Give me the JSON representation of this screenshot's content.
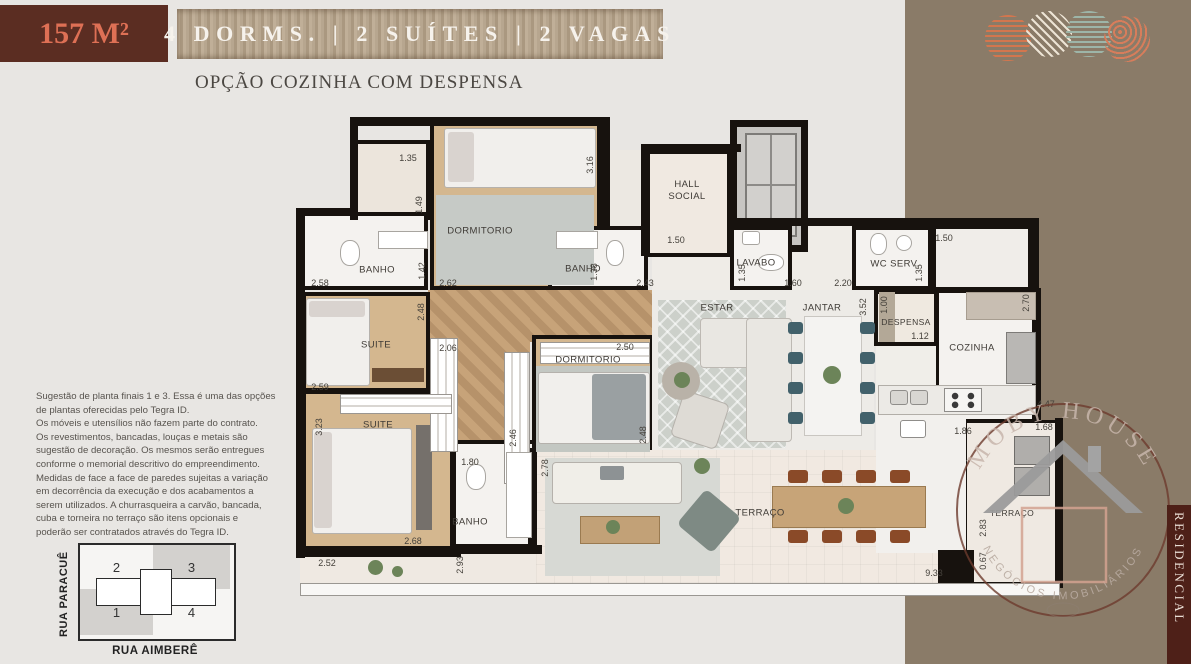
{
  "header": {
    "area": "157 M²",
    "banner": "4 DORMS. | 2 SUÍTES | 2 VAGAS",
    "subtitle": "OPÇÃO COZINHA COM DESPENSA"
  },
  "disclaimer": "Sugestão de planta finais 1 e 3.  Essa é uma das opções\nde plantas oferecidas pelo Tegra ID.\nOs móveis e utensílios não fazem parte do contrato.\nOs revestimentos, bancadas, louças e metais são\nsugestão de decoração. Os mesmos serão entregues\nconforme  o memorial descritivo do empreendimento.\nMedidas de face a face de paredes sujeitas a variação\nem decorrência da execução e dos acabamentos a\nserem utilizados. A churrasqueira a carvão, bancada,\ncuba e torneira no terraço são itens opcionais e\npoderão ser contratados através do Tegra ID.",
  "key_plan": {
    "street_left": "RUA PARACUÊ",
    "street_bottom": "RUA AIMBERÊ",
    "units": {
      "u1": "1",
      "u2": "2",
      "u3": "3",
      "u4": "4"
    }
  },
  "plan": {
    "rooms": [
      {
        "label": "DORMITORIO"
      },
      {
        "label": "BANHO"
      },
      {
        "label": "BANHO"
      },
      {
        "label": "HALL SOCIAL"
      },
      {
        "label": "LAVABO"
      },
      {
        "label": "WC SERV."
      },
      {
        "label": "SUITE"
      },
      {
        "label": "SUITE"
      },
      {
        "label": "DORMITORIO"
      },
      {
        "label": "ESTAR"
      },
      {
        "label": "JANTAR"
      },
      {
        "label": "DESPENSA"
      },
      {
        "label": "COZINHA"
      },
      {
        "label": "BANHO"
      },
      {
        "label": "TERRAÇO"
      },
      {
        "label": "TERRAÇO"
      }
    ],
    "dims": [
      {
        "v": "1.35"
      },
      {
        "v": "1.49"
      },
      {
        "v": "3.16"
      },
      {
        "v": "2.58"
      },
      {
        "v": "1.42"
      },
      {
        "v": "2.62"
      },
      {
        "v": "1.38"
      },
      {
        "v": "2.43"
      },
      {
        "v": "1.50"
      },
      {
        "v": "1.35"
      },
      {
        "v": "1.60"
      },
      {
        "v": "2.20"
      },
      {
        "v": "1.35"
      },
      {
        "v": "1.50"
      },
      {
        "v": "2.70"
      },
      {
        "v": "3.52"
      },
      {
        "v": "1.00"
      },
      {
        "v": "1.12"
      },
      {
        "v": "2.06"
      },
      {
        "v": "2.48"
      },
      {
        "v": "2.50"
      },
      {
        "v": "2.59"
      },
      {
        "v": "3.23"
      },
      {
        "v": "2.46"
      },
      {
        "v": "2.48"
      },
      {
        "v": "1.80"
      },
      {
        "v": "2.78"
      },
      {
        "v": "2.68"
      },
      {
        "v": "2.52"
      },
      {
        "v": "2.93"
      },
      {
        "v": "1.86"
      },
      {
        "v": "1.68"
      },
      {
        "v": "4.47"
      },
      {
        "v": "2.83"
      },
      {
        "v": "0.67"
      },
      {
        "v": "9.33"
      }
    ]
  },
  "logo": {
    "top": "MOBY HOUSE",
    "bottom": "NEGÓCIOS IMOBILIÁRIOS"
  },
  "side_label": "RESIDENCIAL",
  "colors": {
    "accent": "#de7055",
    "maroon": "#5b2d22",
    "panel": "#8a7b68",
    "wall": "#17120e",
    "chair_teal": "#42616b",
    "chair_brown": "#8a4a28"
  }
}
